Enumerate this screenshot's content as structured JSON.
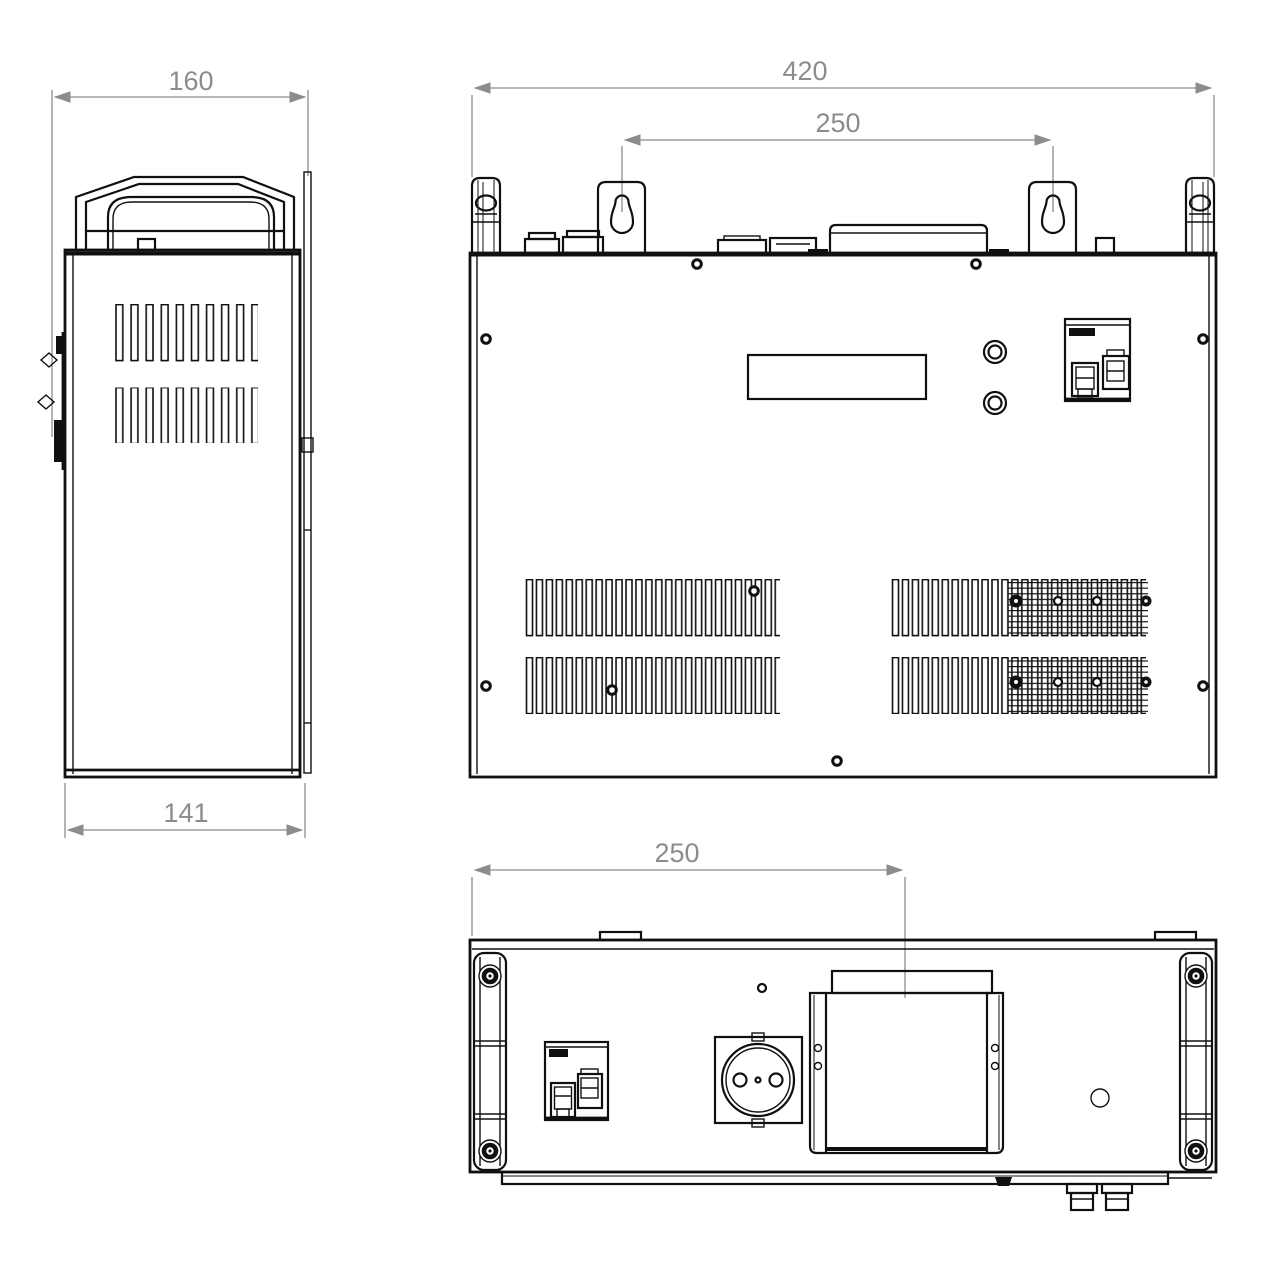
{
  "drawing": {
    "type": "engineering-dimension-drawing-three-views",
    "colors": {
      "line": "#101010",
      "dimension": "#8c8c8c",
      "background": "#ffffff"
    },
    "views": {
      "side": {
        "label": "side-view",
        "dim_top": "160",
        "dim_bottom": "141"
      },
      "front": {
        "label": "front-view",
        "dim_overall": "420",
        "dim_mounts": "250"
      },
      "bottom": {
        "label": "bottom-view",
        "dim_offset": "250"
      }
    }
  }
}
